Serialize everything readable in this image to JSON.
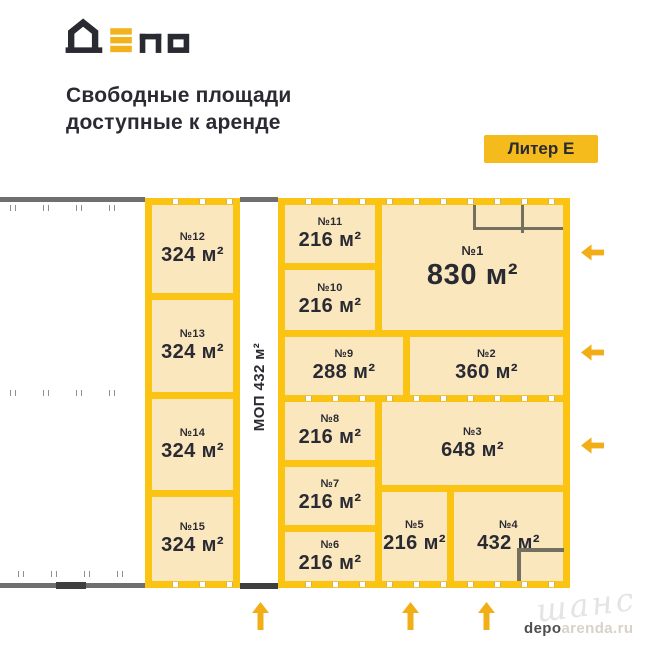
{
  "header": {
    "logo_text": "ДЕПО",
    "title_line1": "Свободные площади",
    "title_line2": "доступные к аренде",
    "badge": "Литер Е"
  },
  "plan": {
    "corridor_label": "МОП 432 м²",
    "units": {
      "u1": {
        "number": "№1",
        "area": "830 м²"
      },
      "u2": {
        "number": "№2",
        "area": "360 м²"
      },
      "u3": {
        "number": "№3",
        "area": "648 м²"
      },
      "u4": {
        "number": "№4",
        "area": "432 м²"
      },
      "u5": {
        "number": "№5",
        "area": "216 м²"
      },
      "u6": {
        "number": "№6",
        "area": "216 м²"
      },
      "u7": {
        "number": "№7",
        "area": "216 м²"
      },
      "u8": {
        "number": "№8",
        "area": "216 м²"
      },
      "u9": {
        "number": "№9",
        "area": "288 м²"
      },
      "u10": {
        "number": "№10",
        "area": "216 м²"
      },
      "u11": {
        "number": "№11",
        "area": "216 м²"
      },
      "u12": {
        "number": "№12",
        "area": "324 м²"
      },
      "u13": {
        "number": "№13",
        "area": "324 м²"
      },
      "u14": {
        "number": "№14",
        "area": "324 м²"
      },
      "u15": {
        "number": "№15",
        "area": "324 м²"
      }
    }
  },
  "watermark": {
    "script": "шанс",
    "site_dark": "depo",
    "site_light": "arenda.ru"
  },
  "colors": {
    "wall_yellow": "#FBC413",
    "unit_cream": "#FAE7BE",
    "ink_dark": "#2A2A33",
    "gray_wall": "#6F6F6F",
    "arrow_yellow": "#F2AE17"
  }
}
